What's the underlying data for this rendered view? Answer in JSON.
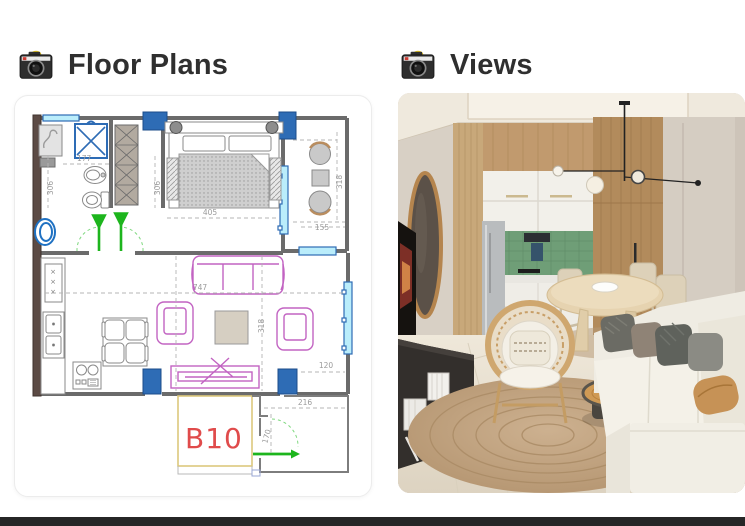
{
  "sections": {
    "floor_plans": {
      "title": "Floor Plans",
      "icon": "camera-icon"
    },
    "views": {
      "title": "Views",
      "icon": "camera-icon"
    }
  },
  "floor_plan": {
    "unit_label": "B10",
    "dimensions": {
      "bath_width": "177",
      "bath_height": "306",
      "bedroom_height": "306",
      "bedroom_width": "405",
      "balcony_height": "318",
      "balcony_width": "155",
      "living_width": "747",
      "living_height": "318",
      "entry_offset": "120",
      "entry_width": "216",
      "entry_depth": "170"
    },
    "colors": {
      "pillar_blue": "#2e6cb5",
      "window_cyan": "#baedfb",
      "furniture_magenta": "#c263c2",
      "door_arrow_green": "#1db51d",
      "unit_label_red": "#e04b4b",
      "bearing_wall_brown": "#5c4b45"
    }
  },
  "view_render": {
    "objects": [
      "ceiling-cove",
      "wood-panel-wall",
      "kitchen-cabinets",
      "green-tile-backsplash",
      "fridge",
      "wardrobe-door",
      "pendant-light",
      "oval-mirror",
      "tv-screen",
      "media-bench",
      "dining-table",
      "rattan-chair",
      "jute-rug",
      "wood-slice-coffee-table",
      "white-sofa"
    ],
    "colors": {
      "ceiling": "#efe9dd",
      "wall_greige": "#d6cec4",
      "wood": "#c49a6c",
      "backsplash_green": "#6f9e77",
      "rug_jute": "#c3a784",
      "sofa_cream": "#f0ede4"
    }
  }
}
